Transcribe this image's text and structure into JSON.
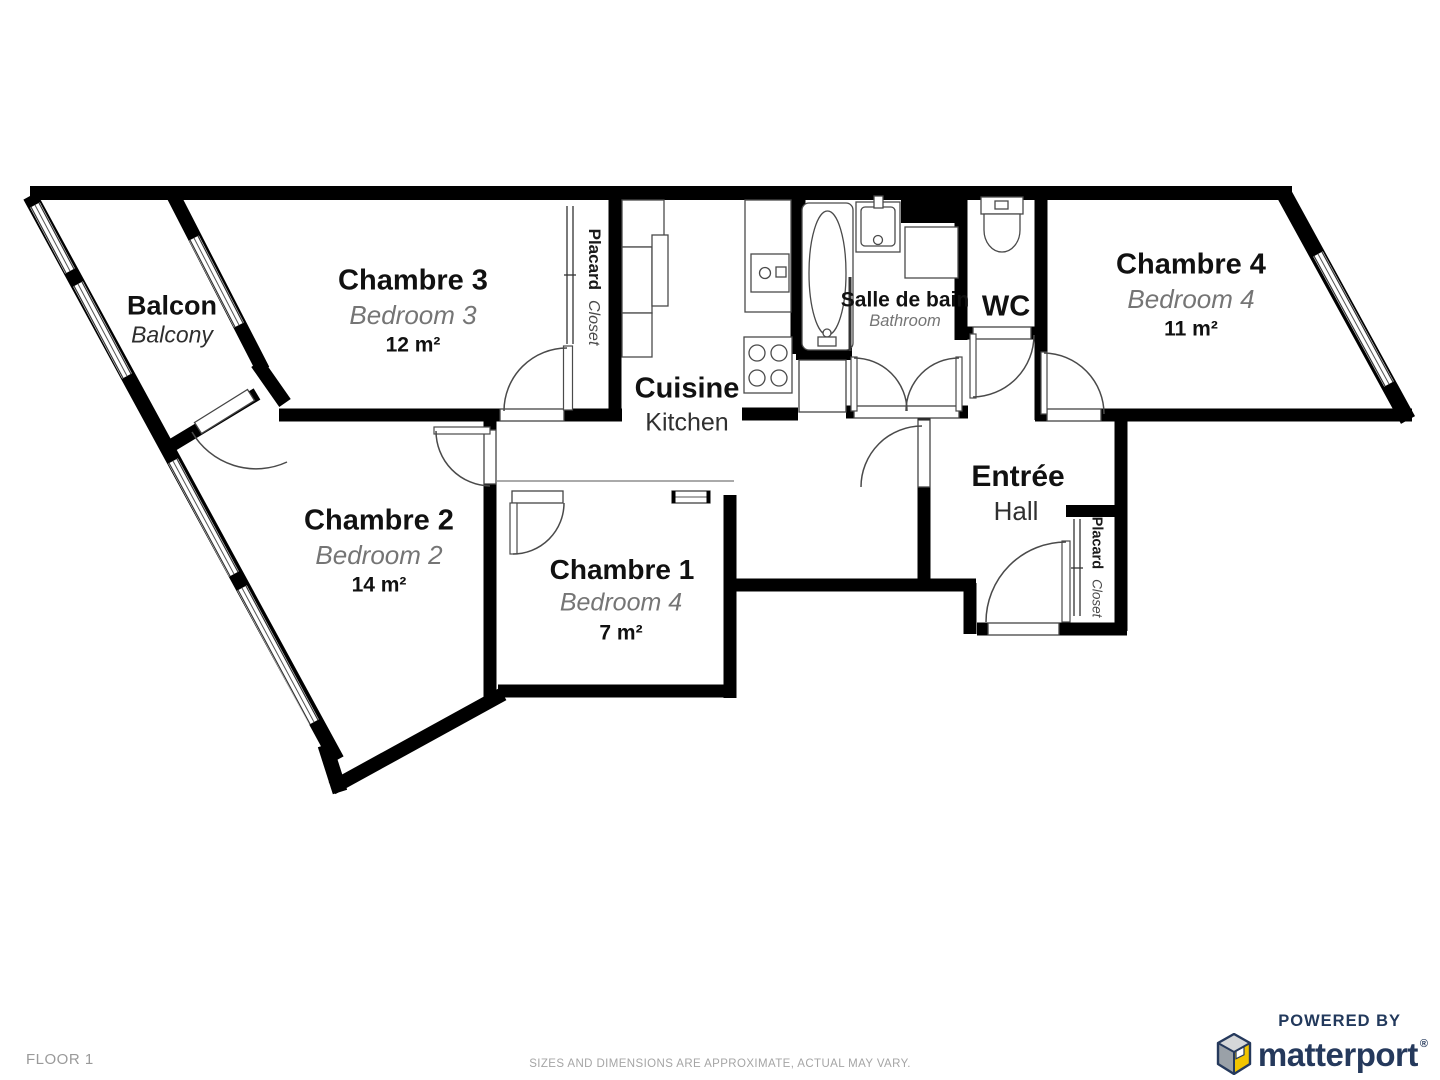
{
  "page": {
    "floor_label": "FLOOR 1",
    "disclaimer": "SIZES AND DIMENSIONS ARE APPROXIMATE, ACTUAL MAY VARY."
  },
  "rooms": {
    "balcony": {
      "name": "Balcon",
      "alt": "Balcony"
    },
    "bedroom3": {
      "name": "Chambre 3",
      "alt": "Bedroom 3",
      "area": "12 m²"
    },
    "bedroom2": {
      "name": "Chambre 2",
      "alt": "Bedroom 2",
      "area": "14 m²"
    },
    "bedroom1": {
      "name": "Chambre 1",
      "alt": "Bedroom 4",
      "area": "7 m²"
    },
    "bedroom4": {
      "name": "Chambre 4",
      "alt": "Bedroom 4",
      "area": "11 m²"
    },
    "kitchen": {
      "name": "Cuisine",
      "alt": "Kitchen"
    },
    "bathroom": {
      "name": "Salle de bain",
      "alt": "Bathroom"
    },
    "wc": {
      "name": "WC"
    },
    "hall": {
      "name": "Entrée",
      "alt": "Hall"
    },
    "closet_bedroom3": {
      "name": "Placard",
      "alt": "Closet"
    },
    "closet_hall": {
      "name": "Placard",
      "alt": "Closet"
    }
  },
  "branding": {
    "powered_by": "POWERED BY",
    "brand": "matterport",
    "registered": "®"
  },
  "icons": {
    "logo_cube": "matterport-isometric-cube"
  },
  "colors": {
    "wall": "#000000",
    "room_name": "#111111",
    "room_alt_gray": "#757575",
    "footer_gray": "#9a9a9a",
    "brand_navy": "#22395c",
    "cube_yellow": "#f2c500",
    "cube_gray_light": "#d5d7d9",
    "cube_gray_mid": "#9aa1a8"
  }
}
